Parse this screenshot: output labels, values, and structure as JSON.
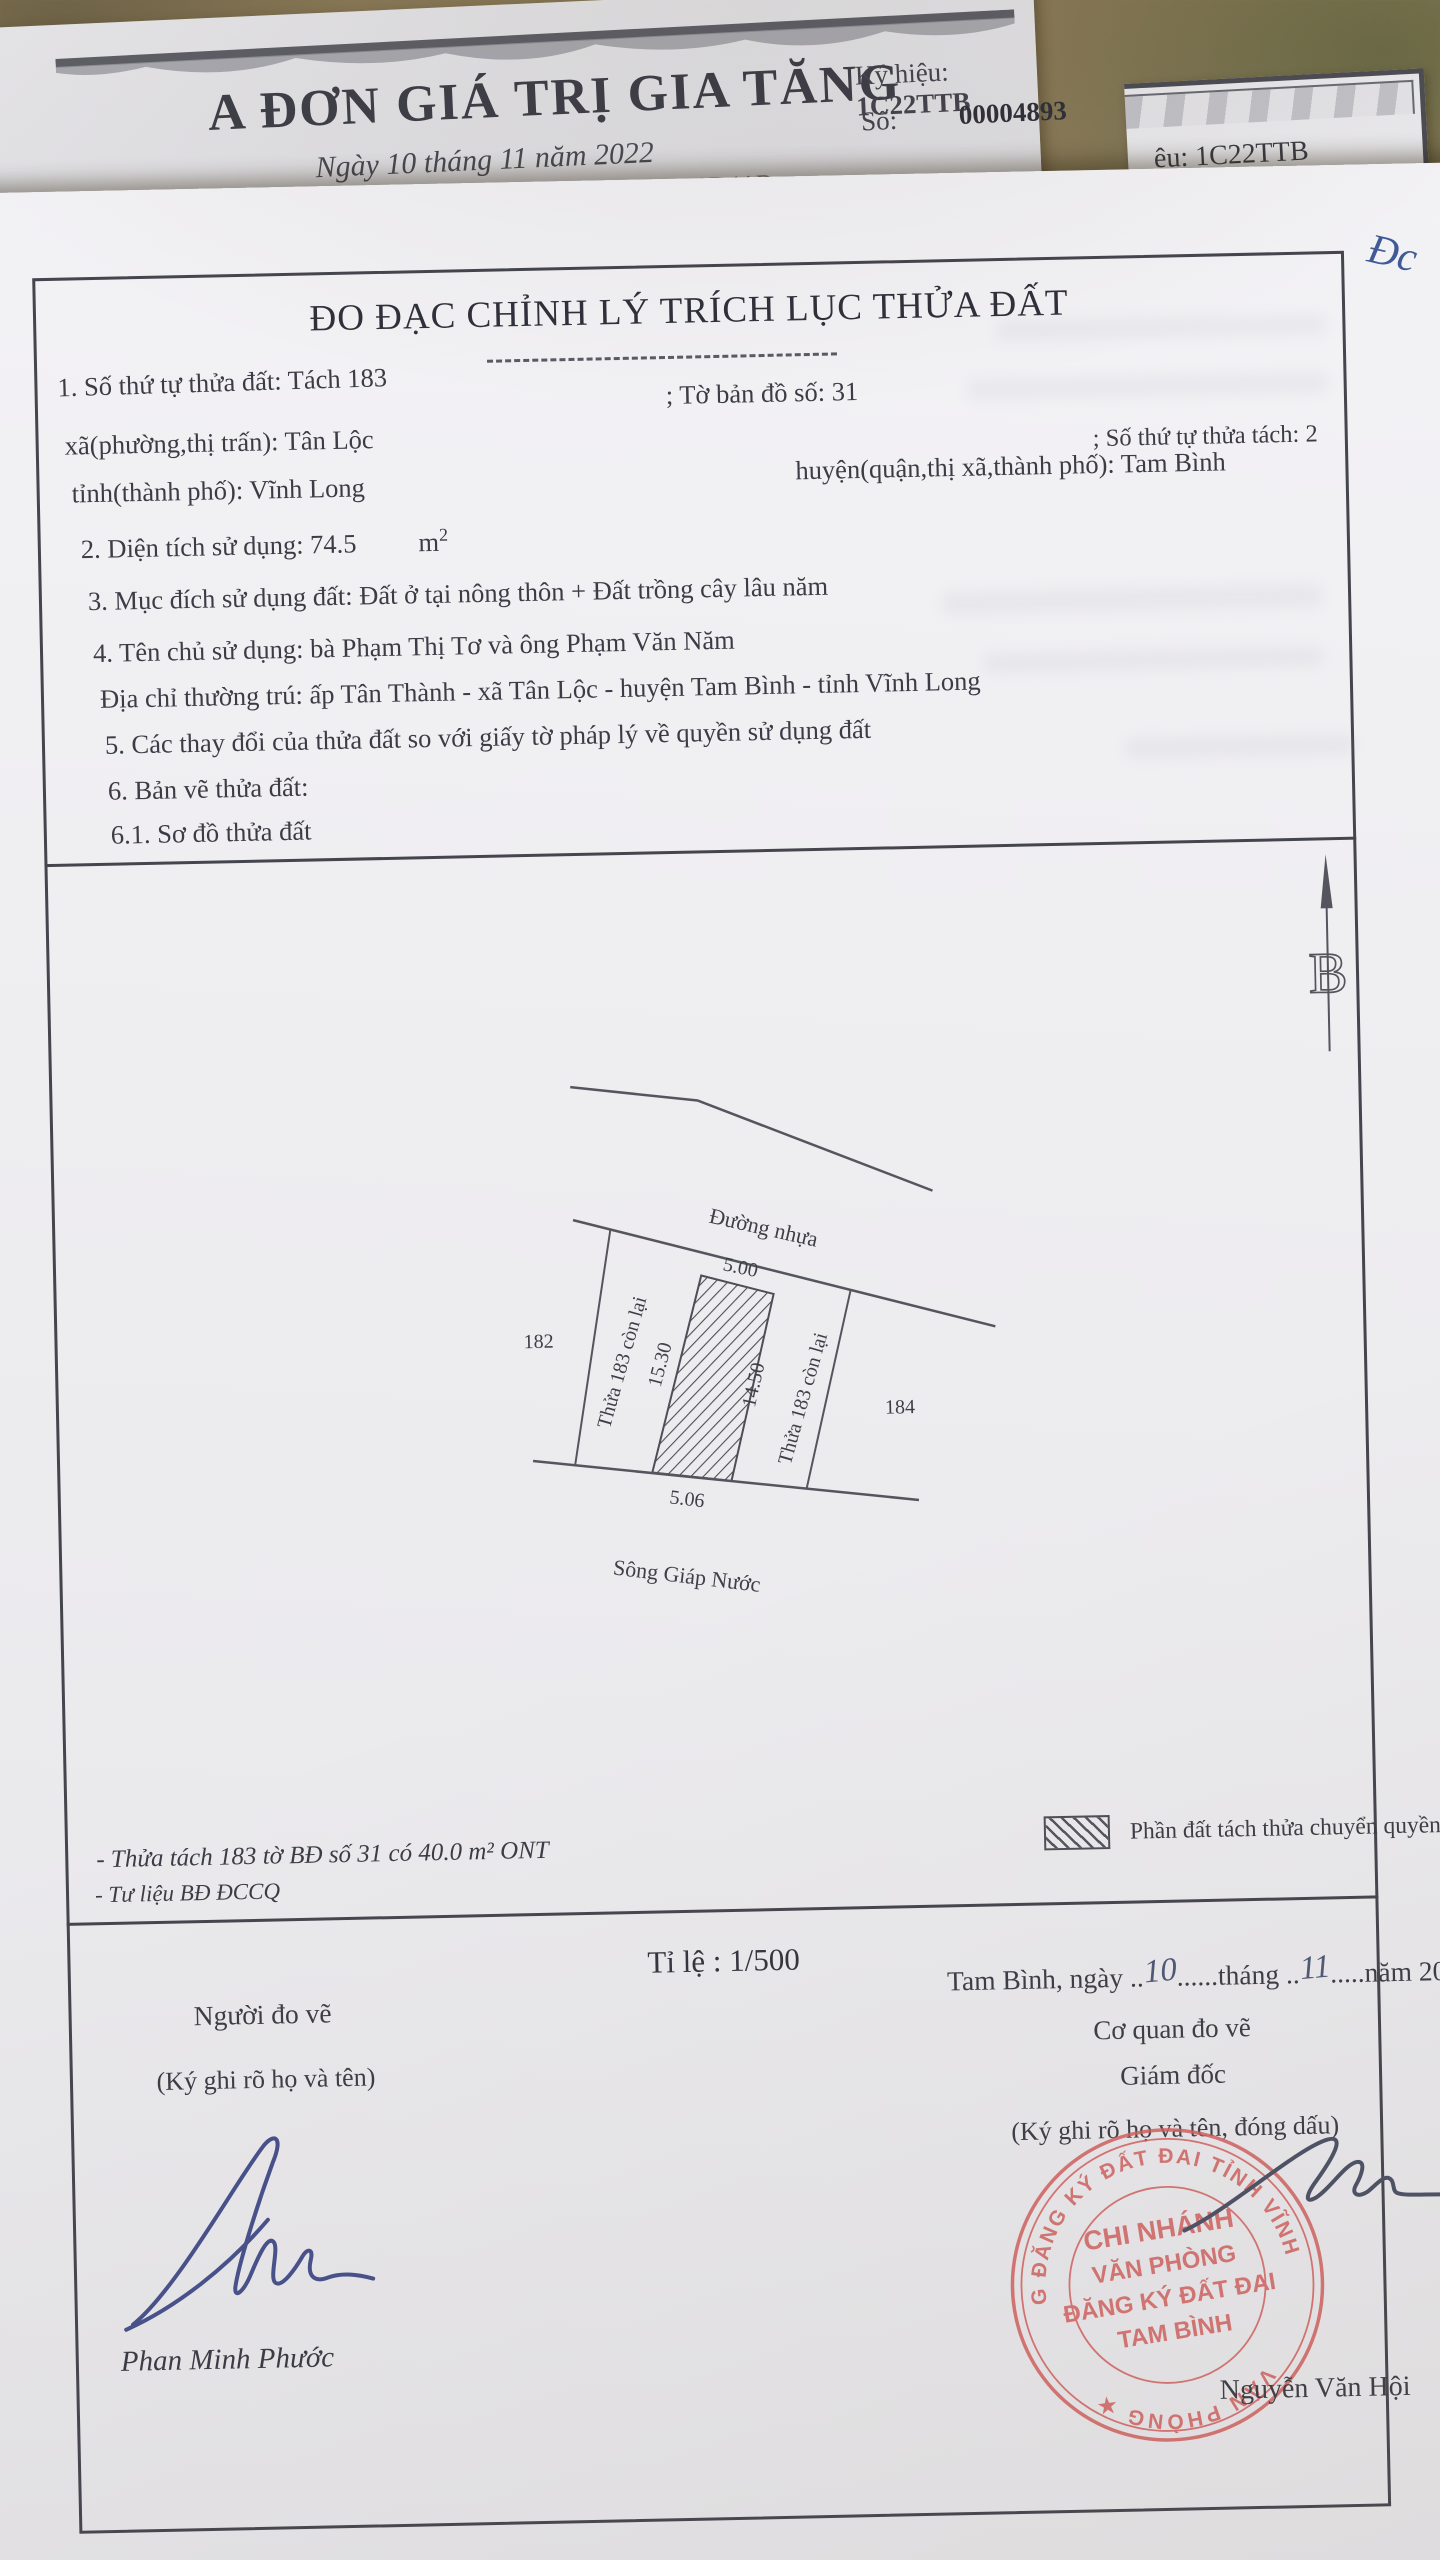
{
  "photo": {
    "corner_scribble": "Đc"
  },
  "invoice": {
    "title": "A ĐƠN GIÁ TRỊ GIA TĂNG",
    "date_line": "Ngày 10 tháng 11 năm 2022",
    "serial_line": "-427BD2A026D11B",
    "ky_hieu_label": "Ký hiệu:",
    "ky_hieu_value": "1C22TTB",
    "so_label": "Số:",
    "so_value": "00004893"
  },
  "second_sheet": {
    "corner_text": "ệu: 1C22TTB"
  },
  "document": {
    "title": "ĐO ĐẠC CHỈNH LÝ TRÍCH LỤC THỬA ĐẤT",
    "info": {
      "l1a": "1. Số thứ tự thửa đất: Tách 183",
      "l1b": "; Tờ bản đồ số: 31",
      "l2a": "xã(phường,thị trấn): Tân Lộc",
      "l2b": "; Số thứ tự thửa tách: 2",
      "l3a": "tỉnh(thành phố): Vĩnh Long",
      "l3b": "huyện(quận,thị xã,thành phố): Tam Bình",
      "l4": "2. Diện tích sử dụng: 74.5",
      "l4_unit": "m",
      "l4_sup": "2",
      "l5": "3. Mục đích sử dụng đất: Đất ở tại nông thôn + Đất trồng cây lâu năm",
      "l6": "4. Tên chủ sử dụng: bà Phạm Thị Tơ và ông Phạm Văn Năm",
      "l7": "Địa chỉ thường trú: ấp Tân Thành - xã Tân Lộc - huyện Tam Bình - tỉnh Vĩnh Long",
      "l8": "5. Các thay đổi của thửa đất so với giấy tờ pháp lý về quyền sử dụng đất",
      "l9": "6. Bản vẽ thửa đất:",
      "l10": "6.1. Sơ đồ thửa đất"
    },
    "sketch": {
      "road_label": "Đường nhựa",
      "dim_top": "5.00",
      "dim_left": "15.30",
      "dim_right": "14.50",
      "dim_bottom": "5.06",
      "parcel_left_label": "Thửa 183 còn lại",
      "parcel_right_label": "Thửa 183 còn lại",
      "neighbor_left": "182",
      "neighbor_right": "184",
      "river_label": "Sông Giáp Nước",
      "north_letter": "B"
    },
    "footer": {
      "note1": "- Thửa tách 183 tờ BĐ số 31 có 40.0 m² ONT",
      "note2": "- Tư liệu BĐ ĐCCQ",
      "legend_label": "Phần đất tách thửa chuyển quyền",
      "scale": "Tỉ lệ : 1/500",
      "date_prefix": "Tam Bình, ngày ..",
      "day_hand": "10",
      "date_mid": "......tháng ..",
      "month_hand": "11",
      "date_suffix": ".....năm 2022",
      "left_role": "Người đo vẽ",
      "left_sign_note": "(Ký ghi rõ họ và tên)",
      "left_name": "Phan Minh Phước",
      "right_org": "Cơ quan đo vẽ",
      "right_role": "Giám đốc",
      "right_sign_note": "(Ký ghi rõ họ và tên, đóng dấu)",
      "right_name": "Nguyễn Văn Hội",
      "stamp": {
        "ring_top": "PHÒNG ĐĂNG KÝ ĐẤT ĐAI TỈNH VĨNH LONG",
        "ring_bottom": "VĂN PHÒNG ★",
        "line1": "CHI NHÁNH",
        "line2": "VĂN PHÒNG",
        "line3": "ĐĂNG KÝ ĐẤT ĐAI",
        "line4": "TAM BÌNH"
      }
    }
  },
  "colors": {
    "stamp_red": "#d2605f",
    "pen_blue": "#46508b",
    "pen_dark": "#4c5166",
    "paper": "#f1f0f3",
    "ink": "#3c3c46"
  }
}
